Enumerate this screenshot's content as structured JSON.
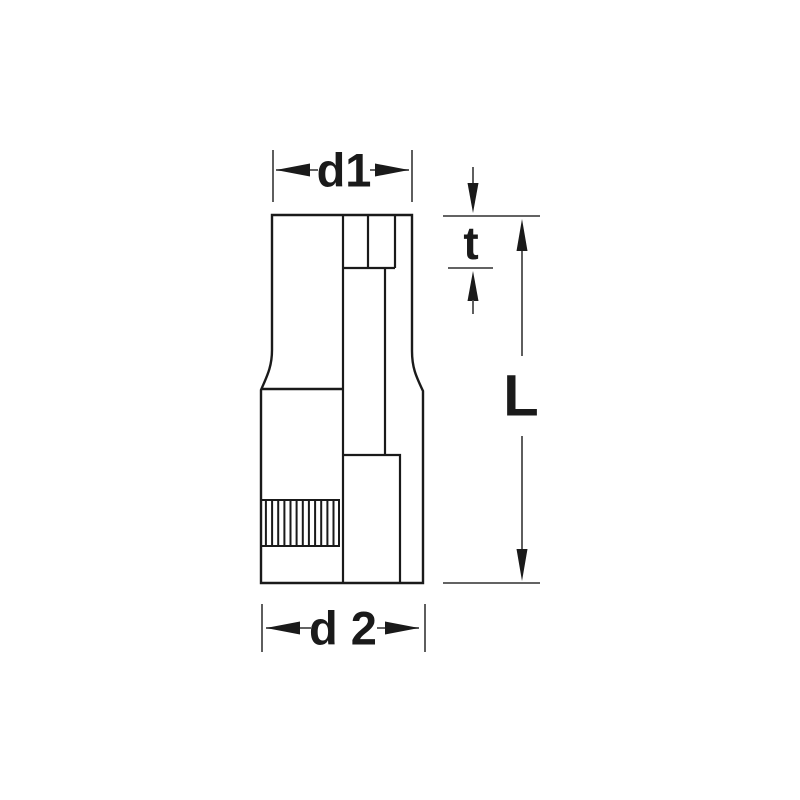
{
  "diagram": {
    "labels": {
      "d1": "d1",
      "t": "t",
      "L": "L",
      "d2": "d 2"
    },
    "colors": {
      "line": "#1a1a1a",
      "dimension_line": "#4d4d4d",
      "background": "#ffffff"
    }
  }
}
